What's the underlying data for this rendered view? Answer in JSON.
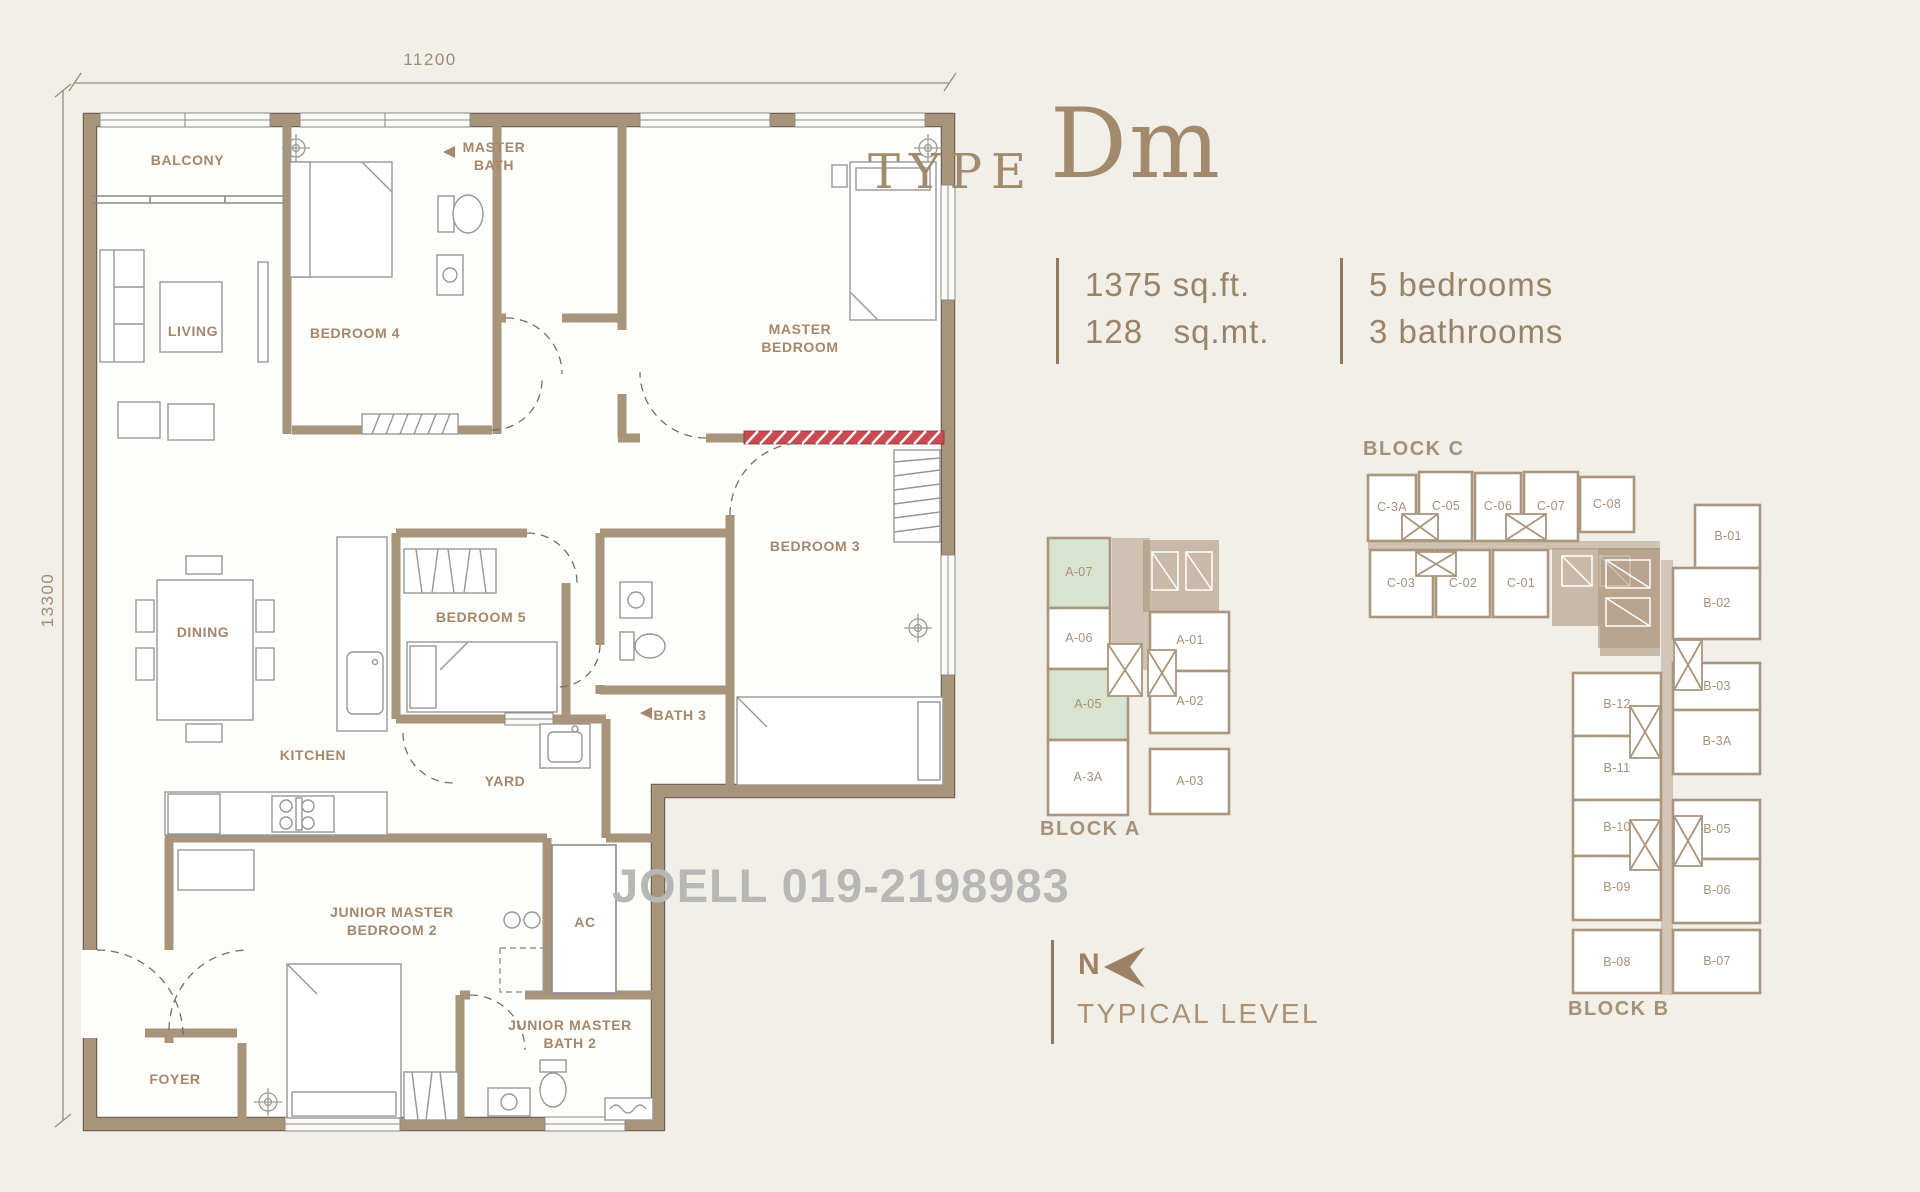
{
  "title": {
    "prefix": "TYPE",
    "name": "Dm"
  },
  "specs": {
    "area_imperial": "1375 sq.ft.",
    "area_metric": "128   sq.mt.",
    "bedrooms": "5 bedrooms",
    "bathrooms": "3 bathrooms"
  },
  "dimensions": {
    "width": "11200",
    "height": "13300"
  },
  "floor_plan": {
    "rooms": [
      {
        "label": "BALCONY"
      },
      {
        "label": "LIVING"
      },
      {
        "label": "BEDROOM 4"
      },
      {
        "label": "MASTER BATH"
      },
      {
        "label": "MASTER BEDROOM"
      },
      {
        "label": "DINING"
      },
      {
        "label": "BEDROOM 5"
      },
      {
        "label": "BATH 3"
      },
      {
        "label": "BEDROOM 3"
      },
      {
        "label": "KITCHEN"
      },
      {
        "label": "YARD"
      },
      {
        "label": "JUNIOR MASTER BEDROOM 2"
      },
      {
        "label": "AC"
      },
      {
        "label": "JUNIOR MASTER BATH 2"
      },
      {
        "label": "FOYER"
      }
    ]
  },
  "watermark": {
    "text": "JOELL 019-2198983"
  },
  "compass": {
    "north": "N",
    "level": "TYPICAL LEVEL"
  },
  "keyplans": {
    "block_a": {
      "label": "BLOCK A",
      "units": [
        {
          "id": "A-07",
          "highlighted": true
        },
        {
          "id": "A-06",
          "highlighted": false
        },
        {
          "id": "A-05",
          "highlighted": true
        },
        {
          "id": "A-3A",
          "highlighted": false
        },
        {
          "id": "A-01",
          "highlighted": false
        },
        {
          "id": "A-02",
          "highlighted": false
        },
        {
          "id": "A-03",
          "highlighted": false
        }
      ]
    },
    "block_c": {
      "label": "BLOCK C",
      "units": [
        {
          "id": "C-3A",
          "highlighted": false
        },
        {
          "id": "C-05",
          "highlighted": false
        },
        {
          "id": "C-06",
          "highlighted": false
        },
        {
          "id": "C-07",
          "highlighted": false
        },
        {
          "id": "C-08",
          "highlighted": false
        },
        {
          "id": "C-03",
          "highlighted": false
        },
        {
          "id": "C-02",
          "highlighted": false
        },
        {
          "id": "C-01",
          "highlighted": false
        }
      ]
    },
    "block_b": {
      "label": "BLOCK B",
      "units": [
        {
          "id": "B-01",
          "highlighted": false
        },
        {
          "id": "B-02",
          "highlighted": false
        },
        {
          "id": "B-03",
          "highlighted": false
        },
        {
          "id": "B-3A",
          "highlighted": false
        },
        {
          "id": "B-05",
          "highlighted": false
        },
        {
          "id": "B-06",
          "highlighted": false
        },
        {
          "id": "B-07",
          "highlighted": false
        },
        {
          "id": "B-12",
          "highlighted": false
        },
        {
          "id": "B-11",
          "highlighted": false
        },
        {
          "id": "B-10",
          "highlighted": false
        },
        {
          "id": "B-09",
          "highlighted": false
        },
        {
          "id": "B-08",
          "highlighted": false
        }
      ]
    }
  },
  "colors": {
    "background": "#f2efe8",
    "wall_tan": "#a8937b",
    "label_brown": "#a5876b",
    "highlight_green": "#d8e4d0",
    "watermark_gray": "#b7b7b5",
    "hatch_red": "#c94a52"
  }
}
